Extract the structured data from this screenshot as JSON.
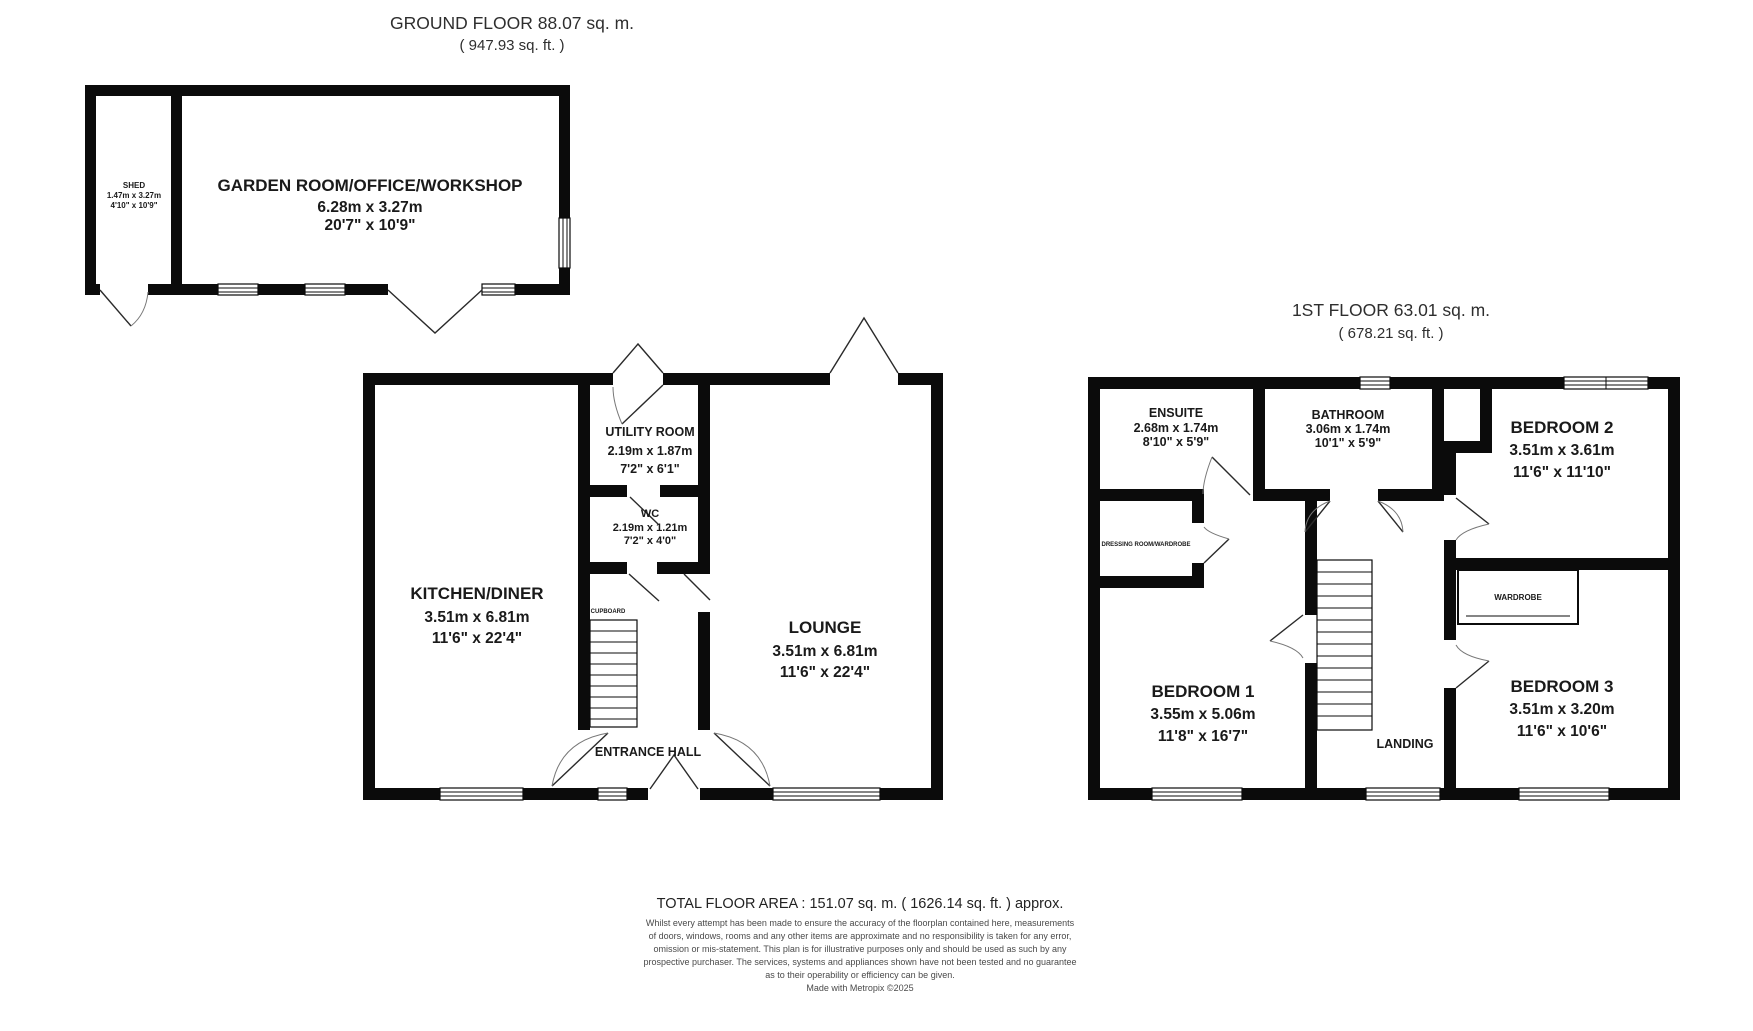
{
  "ground_floor": {
    "title": "GROUND FLOOR 88.07 sq. m.",
    "subtitle": "( 947.93 sq. ft. )",
    "rooms": {
      "shed": {
        "name": "SHED",
        "metric": "1.47m x 3.27m",
        "imperial": "4'10\" x 10'9\""
      },
      "garden_room": {
        "name": "GARDEN ROOM/OFFICE/WORKSHOP",
        "metric": "6.28m x 3.27m",
        "imperial": "20'7\" x 10'9\""
      },
      "kitchen_diner": {
        "name": "KITCHEN/DINER",
        "metric": "3.51m x 6.81m",
        "imperial": "11'6\" x 22'4\""
      },
      "utility_room": {
        "name": "UTILITY ROOM",
        "metric": "2.19m x 1.87m",
        "imperial": "7'2\" x 6'1\""
      },
      "wc": {
        "name": "WC",
        "metric": "2.19m x 1.21m",
        "imperial": "7'2\" x 4'0\""
      },
      "lounge": {
        "name": "LOUNGE",
        "metric": "3.51m x 6.81m",
        "imperial": "11'6\" x 22'4\""
      },
      "entrance_hall": {
        "name": "ENTRANCE HALL"
      },
      "cupboard": {
        "name": "CUPBOARD"
      }
    }
  },
  "first_floor": {
    "title": "1ST FLOOR 63.01 sq. m.",
    "subtitle": "( 678.21 sq. ft. )",
    "rooms": {
      "ensuite": {
        "name": "ENSUITE",
        "metric": "2.68m x 1.74m",
        "imperial": "8'10\" x 5'9\""
      },
      "bathroom": {
        "name": "BATHROOM",
        "metric": "3.06m x 1.74m",
        "imperial": "10'1\" x 5'9\""
      },
      "bedroom2": {
        "name": "BEDROOM 2",
        "metric": "3.51m x 3.61m",
        "imperial": "11'6\" x 11'10\""
      },
      "bedroom1": {
        "name": "BEDROOM 1",
        "metric": "3.55m x 5.06m",
        "imperial": "11'8\" x 16'7\""
      },
      "bedroom3": {
        "name": "BEDROOM 3",
        "metric": "3.51m x 3.20m",
        "imperial": "11'6\" x 10'6\""
      },
      "landing": {
        "name": "LANDING"
      },
      "wardrobe": {
        "name": "WARDROBE"
      },
      "dressing": {
        "name": "DRESSING ROOM/WARDROBE"
      }
    }
  },
  "footer": {
    "total_area": "TOTAL FLOOR AREA : 151.07 sq. m. ( 1626.14 sq. ft. ) approx.",
    "disclaimer_lines": [
      "Whilst every attempt has been made to ensure the accuracy of the floorplan contained here, measurements",
      "of doors, windows, rooms and any other items are approximate and no responsibility is taken for any error,",
      "omission or mis-statement. This plan is for illustrative purposes only and should be used as such by any",
      "prospective purchaser. The services, systems and appliances shown have not been tested and no guarantee",
      "as to their operability or efficiency can be given."
    ],
    "credit": "Made with Metropix ©2025"
  },
  "colors": {
    "wall": "#0b0b0b",
    "text": "#1a1a1a"
  }
}
